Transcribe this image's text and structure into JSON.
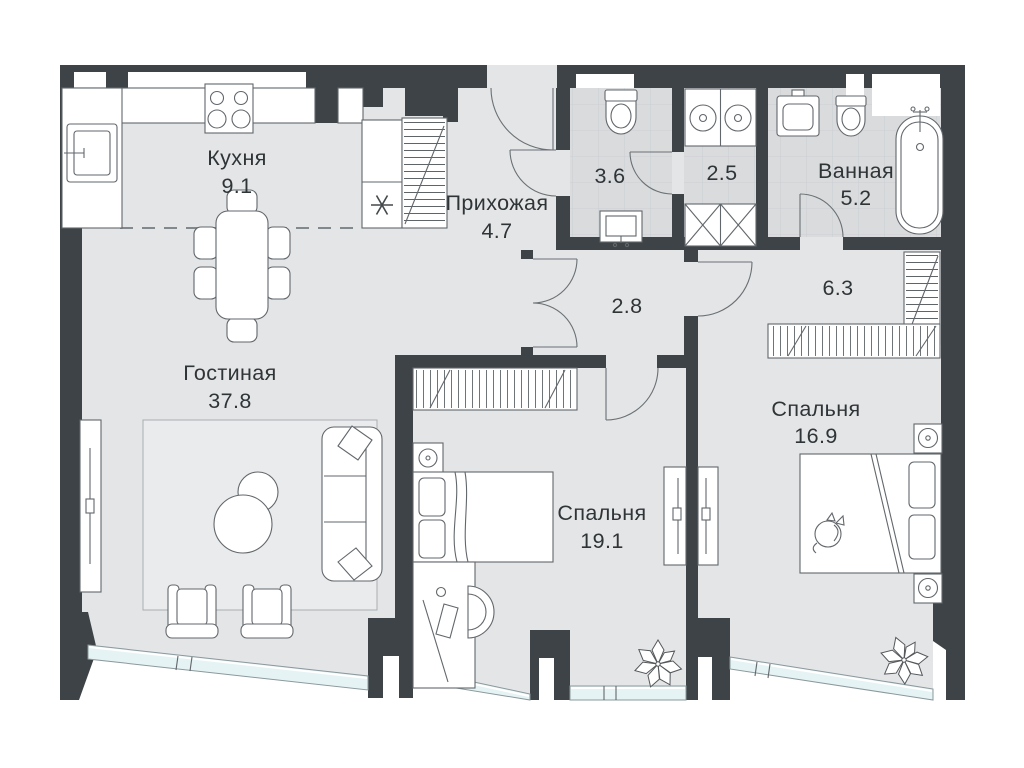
{
  "plan": {
    "type": "apartment-floor-plan",
    "rooms": [
      {
        "key": "kitchen",
        "label": "Кухня",
        "area": "9.1"
      },
      {
        "key": "hallway",
        "label": "Прихожая",
        "area": "4.7"
      },
      {
        "key": "wc",
        "label": "",
        "area": "3.6"
      },
      {
        "key": "laundry",
        "label": "",
        "area": "2.5"
      },
      {
        "key": "bathroom",
        "label": "Ванная",
        "area": "5.2"
      },
      {
        "key": "corridor",
        "label": "",
        "area": "2.8"
      },
      {
        "key": "dressing",
        "label": "",
        "area": "6.3"
      },
      {
        "key": "living",
        "label": "Гостиная",
        "area": "37.8"
      },
      {
        "key": "bedroom-1",
        "label": "Спальня",
        "area": "19.1"
      },
      {
        "key": "bedroom-2",
        "label": "Спальня",
        "area": "16.9"
      }
    ],
    "icons": {
      "fridge": "snowflake-asterisk",
      "plants": "leafy-plant",
      "cat": "sleeping-cat"
    },
    "colors": {
      "wall": "#3e4347",
      "floor": "#e4e5e7",
      "wet_floor": "#d9dbdd",
      "window_glass": "#e6f3f5",
      "rug": "#eaebed",
      "furniture_line": "#62676b",
      "text": "#2f3437"
    }
  }
}
